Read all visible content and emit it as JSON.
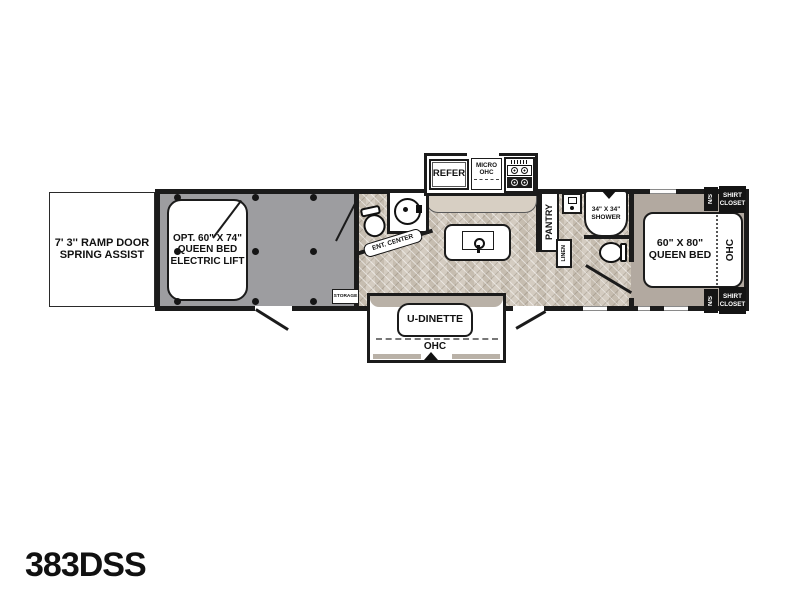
{
  "model": "383DSS",
  "colors": {
    "wall": "#1b1b1b",
    "garage_floor": "#9d9da0",
    "bedroom_floor": "#b2a9a0",
    "main_floor": "#cfc6ba",
    "counter": "#d7cfc3",
    "slide_band": "#b9b1a7"
  },
  "garage": {
    "ramp_line1": "7' 3'' RAMP DOOR",
    "ramp_line2": "SPRING ASSIST",
    "bed_line1": "OPT. 60\" X 74\"",
    "bed_line2": "QUEEN BED",
    "bed_line3": "ELECTRIC LIFT",
    "storage": "STORAGE"
  },
  "kitchen": {
    "refer": "REFER",
    "micro_line1": "MICRO",
    "micro_line2": "OHC",
    "ent_center": "ENT. CENTER"
  },
  "dinette": {
    "table": "U-DINETTE",
    "ohc": "OHC"
  },
  "bath": {
    "pantry": "PANTRY",
    "shower_line1": "34\" X 34\"",
    "shower_line2": "SHOWER",
    "linen": "LINEN"
  },
  "bedroom": {
    "bed_line1": "60\" X 80\"",
    "bed_line2": "QUEEN BED",
    "ohc": "OHC",
    "ns": "N/S",
    "shirt_line1": "SHIRT",
    "shirt_line2": "CLOSET"
  },
  "icons": {
    "range_icon": "four-burner-cooktop",
    "sink_icon": "round-vessel-sink",
    "island_sink_icon": "kitchen-sink-faucet",
    "toilet_icon": "toilet",
    "vent_icon": "roof-vent-triangle",
    "slide_arrow_icon": "slideout-direction-arrow",
    "tie_down_icon": "tie-down-anchor"
  }
}
